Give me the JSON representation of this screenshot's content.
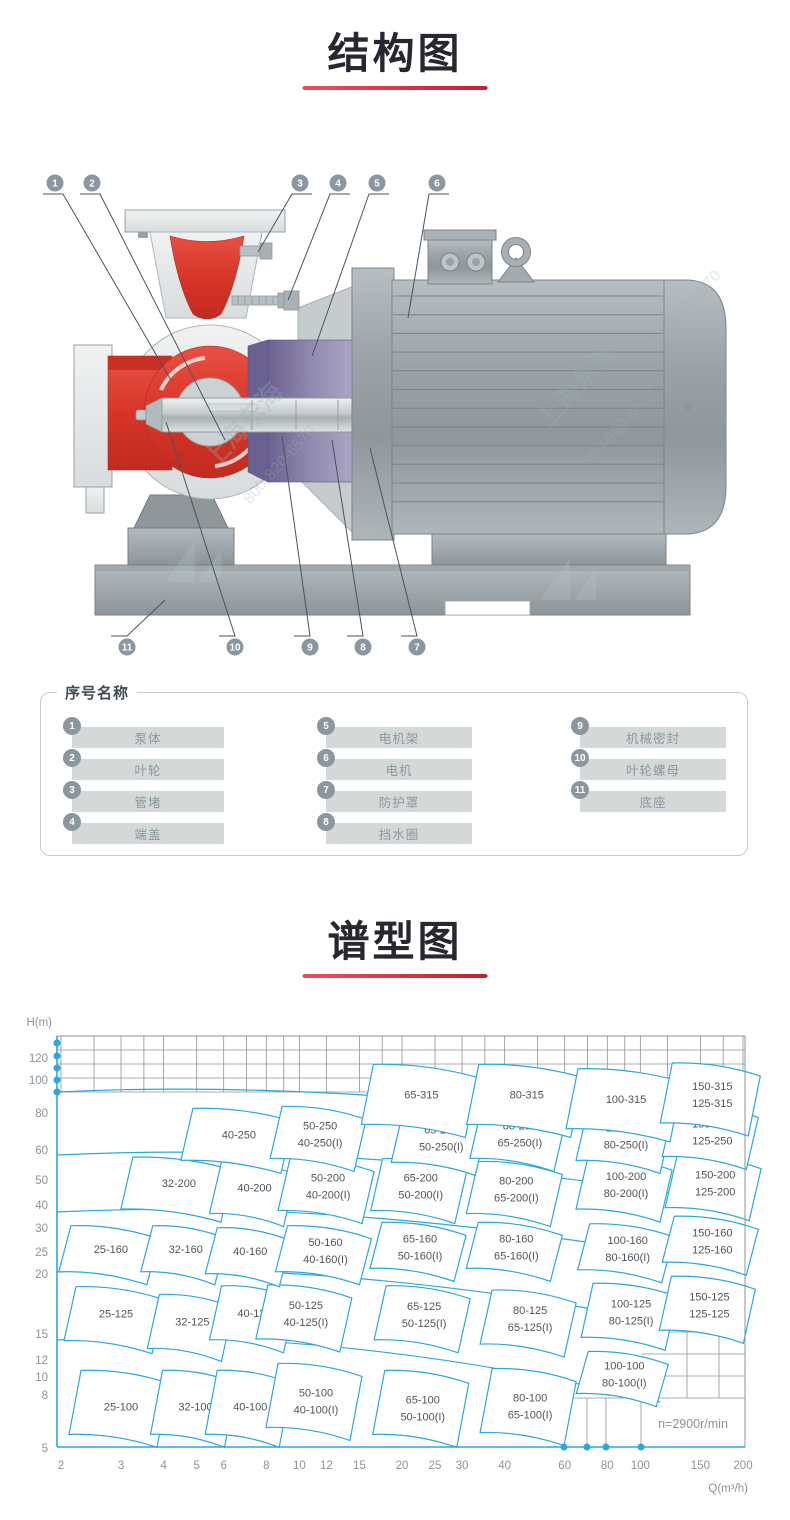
{
  "sections": {
    "structure": {
      "title": "结构图",
      "underline_color": "#c2202f"
    },
    "spectrum": {
      "title": "谱型图",
      "underline_color": "#c2202f"
    }
  },
  "diagram": {
    "callouts": [
      "1",
      "2",
      "3",
      "4",
      "5",
      "6",
      "7",
      "8",
      "9",
      "10",
      "11"
    ],
    "watermark": {
      "name_text": "上海东海",
      "phone_text": "800-820-6570"
    },
    "colors": {
      "red": "#d73528",
      "purple": "#7a7099",
      "gray": "#9aa2a6",
      "badge": "#8a97a0"
    }
  },
  "legend": {
    "header": "序号名称",
    "items": [
      {
        "num": "1",
        "name": "泵体"
      },
      {
        "num": "2",
        "name": "叶轮"
      },
      {
        "num": "3",
        "name": "管堵"
      },
      {
        "num": "4",
        "name": "端盖"
      },
      {
        "num": "5",
        "name": "电机架"
      },
      {
        "num": "6",
        "name": "电机"
      },
      {
        "num": "7",
        "name": "防护罩"
      },
      {
        "num": "8",
        "name": "挡水圈"
      },
      {
        "num": "9",
        "name": "机械密封"
      },
      {
        "num": "10",
        "name": "叶轮螺母"
      },
      {
        "num": "11",
        "name": "底座"
      }
    ]
  },
  "chart_data": {
    "type": "area",
    "subtype": "pump-selection-map",
    "title": "谱型图",
    "xlabel": "Q(m³/h)",
    "ylabel": "H(m)",
    "x_scale": "log",
    "y_scale": "log",
    "x_range": [
      2,
      200
    ],
    "y_range": [
      5,
      140
    ],
    "x_ticks": [
      2,
      3,
      4,
      5,
      6,
      8,
      10,
      12,
      15,
      20,
      25,
      30,
      40,
      60,
      80,
      100,
      150,
      200
    ],
    "y_ticks": [
      120,
      100,
      80,
      60,
      50,
      40,
      30,
      25,
      20,
      15,
      12,
      10,
      8,
      5
    ],
    "speed_label": "n=2900r/min",
    "accent": "#2ba7de",
    "grid_band_heads": [
      90,
      100,
      110,
      120,
      130,
      140
    ],
    "tiles": [
      {
        "row": "100",
        "q": 3.0,
        "h": 7.0,
        "lines": [
          "25-100"
        ]
      },
      {
        "row": "100",
        "q": 4.7,
        "h": 7.0,
        "lines": [
          "32-100"
        ]
      },
      {
        "row": "100",
        "q": 6.8,
        "h": 7.0,
        "lines": [
          "40-100"
        ]
      },
      {
        "row": "100",
        "q": 10.6,
        "h": 7.4,
        "lines": [
          "50-100",
          "40-100(I)"
        ]
      },
      {
        "row": "100",
        "q": 21.8,
        "h": 7.0,
        "lines": [
          "65-100",
          "50-100(I)"
        ]
      },
      {
        "row": "100",
        "q": 45,
        "h": 7.1,
        "lines": [
          "80-100",
          "65-100(I)"
        ]
      },
      {
        "row": "100",
        "q": 85,
        "h": 9.2,
        "small": true,
        "lines": [
          "100-100",
          "80-100(I)"
        ]
      },
      {
        "row": "125",
        "q": 2.9,
        "h": 14.8,
        "lines": [
          "25-125"
        ]
      },
      {
        "row": "125",
        "q": 4.6,
        "h": 13.9,
        "lines": [
          "32-125"
        ]
      },
      {
        "row": "125",
        "q": 7.0,
        "h": 14.9,
        "lines": [
          "40-125"
        ]
      },
      {
        "row": "125",
        "q": 9.9,
        "h": 15.0,
        "lines": [
          "50-125",
          "40-125(I)"
        ]
      },
      {
        "row": "125",
        "q": 22,
        "h": 14.9,
        "lines": [
          "65-125",
          "50-125(I)"
        ]
      },
      {
        "row": "125",
        "q": 45,
        "h": 14.4,
        "lines": [
          "80-125",
          "65-125(I)"
        ]
      },
      {
        "row": "125",
        "q": 89,
        "h": 15.2,
        "lines": [
          "100-125",
          "80-125(I)"
        ]
      },
      {
        "row": "125",
        "q": 151,
        "h": 16.1,
        "lines": [
          "150-125",
          "125-125"
        ]
      },
      {
        "row": "160",
        "q": 2.8,
        "h": 25,
        "lines": [
          "25-160"
        ]
      },
      {
        "row": "160",
        "q": 4.4,
        "h": 25,
        "lines": [
          "32-160"
        ]
      },
      {
        "row": "160",
        "q": 6.8,
        "h": 24.6,
        "lines": [
          "40-160"
        ]
      },
      {
        "row": "160",
        "q": 11.3,
        "h": 25,
        "lines": [
          "50-160",
          "40-160(I)"
        ]
      },
      {
        "row": "160",
        "q": 21.4,
        "h": 25.7,
        "lines": [
          "65-160",
          "50-160(I)"
        ]
      },
      {
        "row": "160",
        "q": 41,
        "h": 25.7,
        "lines": [
          "80-160",
          "65-160(I)"
        ]
      },
      {
        "row": "160",
        "q": 87,
        "h": 25.4,
        "lines": [
          "100-160",
          "80-160(I)"
        ]
      },
      {
        "row": "160",
        "q": 154,
        "h": 27,
        "lines": [
          "150-160",
          "125-160"
        ]
      },
      {
        "row": "200",
        "q": 4.2,
        "h": 42.5,
        "lines": [
          "32-200"
        ]
      },
      {
        "row": "200",
        "q": 7.0,
        "h": 41,
        "lines": [
          "40-200"
        ]
      },
      {
        "row": "200",
        "q": 11.5,
        "h": 42,
        "lines": [
          "50-200",
          "40-200(I)"
        ]
      },
      {
        "row": "200",
        "q": 21.5,
        "h": 42,
        "lines": [
          "65-200",
          "50-200(I)"
        ]
      },
      {
        "row": "200",
        "q": 41,
        "h": 41,
        "lines": [
          "80-200",
          "65-200(I)"
        ]
      },
      {
        "row": "200",
        "q": 86,
        "h": 42.5,
        "lines": [
          "100-200",
          "80-200(I)"
        ]
      },
      {
        "row": "200",
        "q": 157,
        "h": 43,
        "lines": [
          "150-200",
          "125-200"
        ]
      },
      {
        "row": "250",
        "q": 6.3,
        "h": 63,
        "lines": [
          "40-250"
        ]
      },
      {
        "row": "250",
        "q": 10.9,
        "h": 64,
        "lines": [
          "50-250",
          "40-250(I)"
        ]
      },
      {
        "row": "250",
        "q": 24.7,
        "h": 62,
        "lines": [
          "65-250",
          "50-250(I)"
        ]
      },
      {
        "row": "250",
        "q": 42,
        "h": 64,
        "lines": [
          "80-250",
          "65-250(I)"
        ]
      },
      {
        "row": "250",
        "q": 86,
        "h": 63,
        "lines": [
          "100-250",
          "80-250(I)"
        ]
      },
      {
        "row": "250",
        "q": 154,
        "h": 65,
        "lines": [
          "150-250",
          "125-250"
        ]
      },
      {
        "row": "315",
        "q": 21.6,
        "h": 87,
        "lines": [
          "65-315"
        ]
      },
      {
        "row": "315",
        "q": 44,
        "h": 87,
        "lines": [
          "80-315"
        ]
      },
      {
        "row": "315",
        "q": 86,
        "h": 84,
        "lines": [
          "100-315"
        ]
      },
      {
        "row": "315",
        "q": 154,
        "h": 88,
        "lines": [
          "150-315",
          "125-315"
        ]
      }
    ]
  }
}
